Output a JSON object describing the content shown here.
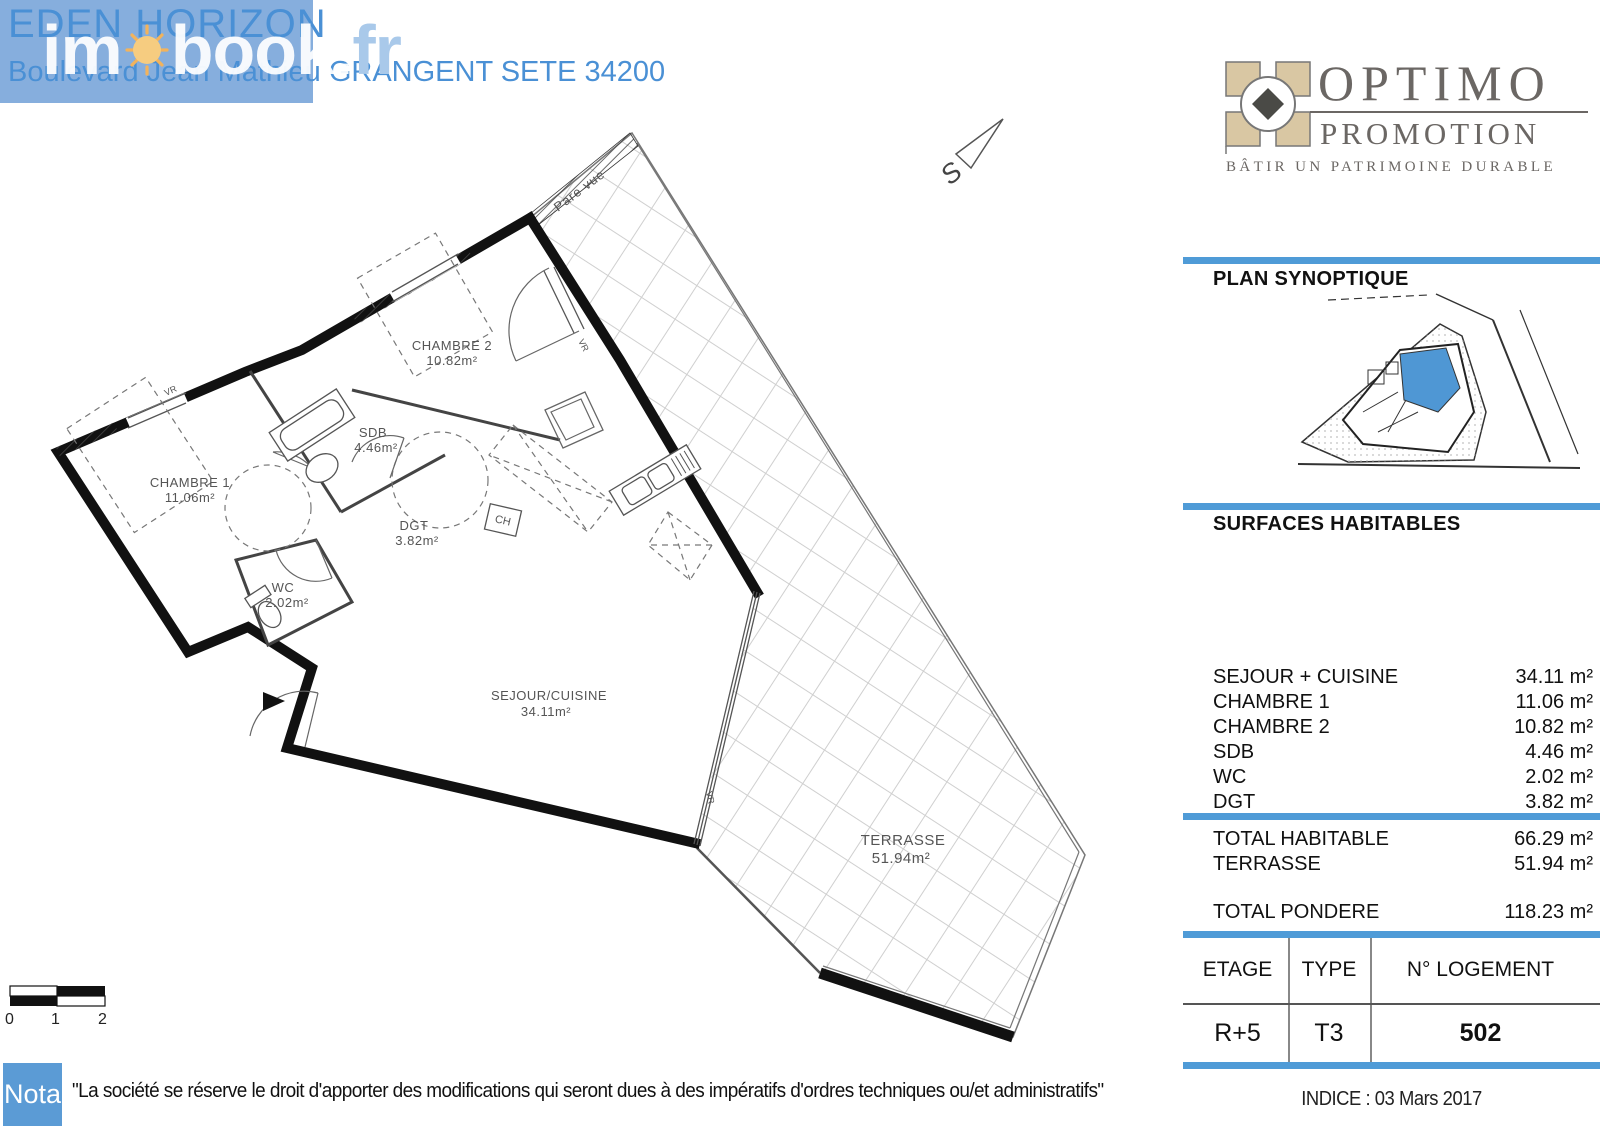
{
  "header": {
    "project_title": "EDEN HORIZON",
    "address": "Boulevard Jean Mathieu GRANGENT SETE 34200",
    "watermark_im": "im",
    "watermark_book": "book",
    "watermark_dot": ".",
    "watermark_fr": "fr",
    "box_color": "#86aedd",
    "text_color": "#4a90d5"
  },
  "developer_logo": {
    "name": "OPTIMO",
    "subtitle": "PROMOTION",
    "tagline": "BÂTIR UN PATRIMOINE DURABLE",
    "emblem_color": "#d9c7a3",
    "text_color": "#6b6764"
  },
  "right_panel": {
    "accent_color": "#4f9bd7",
    "plan_synoptique_title": "PLAN SYNOPTIQUE",
    "surfaces_title": "SURFACES HABITABLES",
    "surfaces_rows": [
      {
        "label": "SEJOUR + CUISINE",
        "value": "34.11 m²"
      },
      {
        "label": "CHAMBRE 1",
        "value": "11.06 m²"
      },
      {
        "label": "CHAMBRE 2",
        "value": "10.82 m²"
      },
      {
        "label": "SDB",
        "value": "4.46 m²"
      },
      {
        "label": "WC",
        "value": "2.02 m²"
      },
      {
        "label": "DGT",
        "value": "3.82 m²"
      }
    ],
    "totals": [
      {
        "label": "TOTAL HABITABLE",
        "value": "66.29 m²"
      },
      {
        "label": "TERRASSE",
        "value": "51.94 m²"
      }
    ],
    "pondere": {
      "label": "TOTAL PONDERE",
      "value": "118.23 m²"
    },
    "unit_table": {
      "headers": [
        "ETAGE",
        "TYPE",
        "N° LOGEMENT"
      ],
      "values": [
        "R+5",
        "T3",
        "502"
      ]
    },
    "indice": "INDICE : 03 Mars 2017"
  },
  "floor_plan": {
    "rooms": [
      {
        "name": "CHAMBRE 1",
        "area": "11.06m²"
      },
      {
        "name": "CHAMBRE 2",
        "area": "10.82m²"
      },
      {
        "name": "SDB",
        "area": "4.46m²"
      },
      {
        "name": "DGT",
        "area": "3.82m²"
      },
      {
        "name": "WC",
        "area": "2.02m²"
      },
      {
        "name": "SEJOUR/CUISINE",
        "area": "34.11m²"
      },
      {
        "name": "TERRASSE",
        "area": "51.94m²"
      }
    ],
    "annotations": {
      "pare_vue": "Pare vue",
      "vr": "VR",
      "ch": "CH",
      "south": "S"
    },
    "scale_bar": {
      "labels": [
        "0",
        "1",
        "2"
      ]
    }
  },
  "nota": {
    "label": "Nota",
    "text": "\"La société se réserve le droit d'apporter des modifications qui seront dues à des impératifs d'ordres techniques ou/et administratifs\"",
    "box_color": "#5b9bd5"
  }
}
